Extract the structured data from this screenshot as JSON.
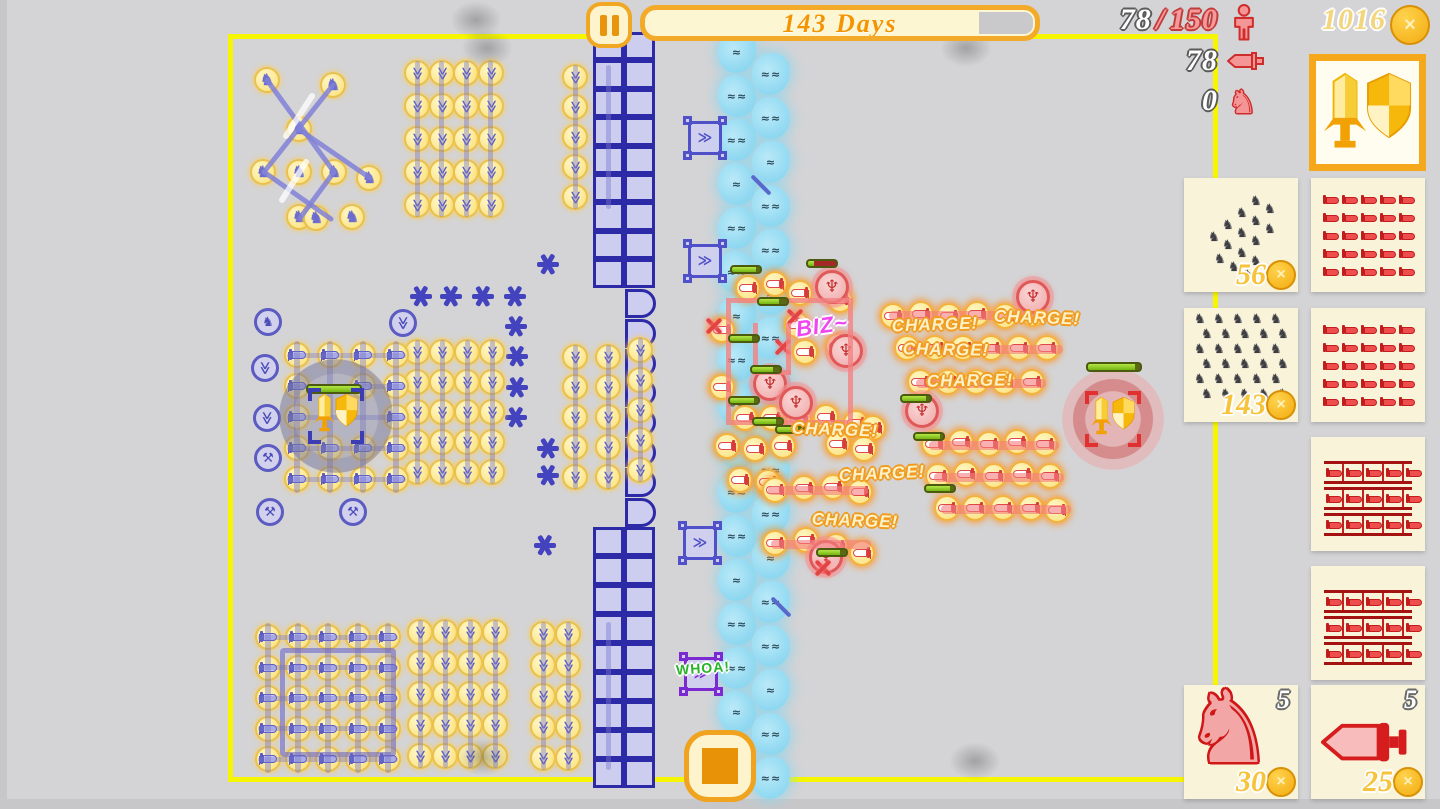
{
  "hud": {
    "days_banner": {
      "label": "143 Days",
      "progress_pct": 86
    },
    "population": {
      "current": "78",
      "sep": "/",
      "max": "150"
    },
    "melee_count": "78",
    "cavalry_count": "0",
    "gold": "1016",
    "icons": {
      "pause": "pause-icon",
      "population": "person-icon",
      "melee": "sword-icon",
      "cavalry": "horse-icon",
      "gold": "coin-icon",
      "stop": "stop-icon"
    },
    "colors": {
      "accent_orange": "#f3aa28",
      "field_border": "#f6f600",
      "banner_text": "#f49400",
      "coin_gold": "#f3ab10"
    }
  },
  "sidebar": {
    "selected_card": {
      "name": "commander-emblem"
    },
    "cards": [
      {
        "id": "cavalry-wedge",
        "glyph": "horse-wedge",
        "count": "56",
        "col": 0,
        "row": 0
      },
      {
        "id": "swords-grid-a",
        "glyph": "sword-grid",
        "col": 1,
        "row": 0
      },
      {
        "id": "cavalry-grid",
        "glyph": "horse-grid",
        "count": "143",
        "col": 0,
        "row": 1
      },
      {
        "id": "swords-grid-b",
        "glyph": "sword-grid",
        "col": 1,
        "row": 1
      },
      {
        "id": "pike-formation-a",
        "glyph": "pike-grid",
        "col": 1,
        "row": 2
      },
      {
        "id": "pike-formation-b",
        "glyph": "pike-grid",
        "col": 1,
        "row": 3
      },
      {
        "id": "cavalry-single",
        "glyph": "horse-big",
        "badge": "5",
        "count": "30",
        "col": 0,
        "row": 4
      },
      {
        "id": "sword-single",
        "glyph": "sword-big",
        "badge": "5",
        "count": "25",
        "col": 1,
        "row": 4
      }
    ]
  },
  "battle": {
    "labels": [
      {
        "text": "CHARGE!",
        "x": 935,
        "y": 325,
        "rot": -2
      },
      {
        "text": "CHARGE!",
        "x": 1037,
        "y": 318,
        "rot": 2
      },
      {
        "text": "CHARGE!",
        "x": 946,
        "y": 350,
        "rot": 1
      },
      {
        "text": "CHARGE!",
        "x": 970,
        "y": 381,
        "rot": -1
      },
      {
        "text": "CHARGE!",
        "x": 835,
        "y": 430,
        "rot": 2
      },
      {
        "text": "CHARGE!",
        "x": 882,
        "y": 474,
        "rot": -3
      },
      {
        "text": "CHARGE!",
        "x": 855,
        "y": 521,
        "rot": 2
      },
      {
        "text": "BIZ~",
        "x": 822,
        "y": 326,
        "rot": -8,
        "style": "biz"
      },
      {
        "text": "WHOA!",
        "x": 703,
        "y": 668,
        "rot": -4,
        "style": "whoa"
      }
    ],
    "blue_cavalry": [
      [
        267,
        80
      ],
      [
        333,
        85
      ],
      [
        299,
        129
      ],
      [
        263,
        172
      ],
      [
        299,
        172
      ],
      [
        334,
        172
      ],
      [
        369,
        178
      ],
      [
        299,
        217
      ],
      [
        352,
        217
      ],
      [
        316,
        218
      ]
    ],
    "cavalry_lines": [
      [
        267,
        80,
        334,
        172
      ],
      [
        333,
        85,
        264,
        172
      ],
      [
        300,
        130,
        370,
        178
      ],
      [
        264,
        172,
        331,
        219
      ],
      [
        334,
        172,
        300,
        218
      ]
    ],
    "white_streaks": [
      [
        312,
        96,
        286,
        136
      ],
      [
        306,
        162,
        282,
        200
      ]
    ],
    "blue_ghosts": [
      [
        268,
        322,
        "h"
      ],
      [
        265,
        368,
        "b"
      ],
      [
        267,
        418,
        "b"
      ],
      [
        268,
        458,
        "m"
      ],
      [
        270,
        512,
        "m"
      ],
      [
        353,
        512,
        "m"
      ],
      [
        403,
        323,
        "b"
      ]
    ],
    "caltrops": [
      [
        548,
        264
      ],
      [
        421,
        296
      ],
      [
        451,
        296
      ],
      [
        483,
        296
      ],
      [
        515,
        296
      ],
      [
        516,
        326
      ],
      [
        517,
        356
      ],
      [
        517,
        387
      ],
      [
        516,
        417
      ],
      [
        548,
        448
      ],
      [
        548,
        475
      ],
      [
        545,
        545
      ]
    ],
    "archer_grids": [
      {
        "x0": 417,
        "y0": 73,
        "dx": 24.5,
        "dy": 33,
        "cols": 4,
        "rows": 5
      },
      {
        "xs": [
          575,
          608
        ],
        "y0": 77,
        "dy": 30,
        "rows": 5
      },
      {
        "x0": 417,
        "y0": 352,
        "dx": 25,
        "dy": 30,
        "cols": 4,
        "rows": 5
      },
      {
        "xs": [
          575,
          608
        ],
        "y0": 357,
        "dy": 30,
        "rows": 5
      },
      {
        "xs": [
          640
        ],
        "y0": 350,
        "dy": 30,
        "rows": 5
      },
      {
        "x0": 420,
        "y0": 632,
        "dx": 25,
        "dy": 31,
        "cols": 4,
        "rows": 5
      },
      {
        "xs": [
          543,
          568
        ],
        "y0": 634,
        "dy": 31,
        "rows": 5
      },
      {
        "xs": [
          608
        ],
        "y0": 634,
        "dy": 31,
        "rows": 5
      }
    ],
    "sword_grids": [
      {
        "xs": [
          297,
          330,
          363,
          396
        ],
        "y0": 355,
        "dy": 31,
        "rows": 5,
        "skip": [
          [
            1,
            1
          ],
          [
            1,
            2
          ],
          [
            2,
            2
          ]
        ]
      },
      {
        "x0": 268,
        "y0": 637,
        "dx": 30,
        "dy": 30.6,
        "cols": 5,
        "rows": 5
      }
    ],
    "bottom_frame": {
      "x": 280,
      "y": 648,
      "w": 106,
      "h": 99
    },
    "wall": {
      "top": {
        "x": 593,
        "y": 32,
        "cols": 2,
        "rows": 9,
        "cw": 31,
        "ch": 28.4
      },
      "bottom": {
        "x": 593,
        "y": 527,
        "cols": 2,
        "rows": 9,
        "cw": 31,
        "ch": 29
      },
      "gates": {
        "x": 625,
        "y": 289,
        "count": 8,
        "dy": 29.8
      }
    },
    "ballistas": [
      {
        "x": 705,
        "y": 138
      },
      {
        "x": 705,
        "y": 261
      },
      {
        "x": 700,
        "y": 543
      },
      {
        "x": 701,
        "y": 674,
        "purple": true
      }
    ],
    "river": {
      "cols": [
        {
          "x": 737,
          "y0": 52
        },
        {
          "x": 771,
          "y0": 74
        }
      ],
      "dy": 44,
      "count": 17
    },
    "fort": {
      "x": 726,
      "y": 298,
      "w": 117,
      "h": 117
    },
    "fort_bars": [
      [
        753,
        323,
        5,
        52
      ],
      [
        786,
        323,
        5,
        52
      ],
      [
        753,
        370,
        38,
        5
      ]
    ],
    "red_units": [
      [
        722,
        330
      ],
      [
        748,
        288
      ],
      [
        775,
        284
      ],
      [
        800,
        293
      ],
      [
        840,
        300
      ],
      [
        797,
        325
      ],
      [
        805,
        352
      ],
      [
        838,
        346
      ],
      [
        722,
        387
      ],
      [
        745,
        418
      ],
      [
        772,
        418
      ],
      [
        799,
        419
      ],
      [
        826,
        417
      ],
      [
        856,
        423
      ],
      [
        873,
        428
      ],
      [
        727,
        446
      ],
      [
        755,
        449
      ],
      [
        783,
        446
      ],
      [
        838,
        444
      ],
      [
        864,
        449
      ],
      [
        740,
        480
      ],
      [
        768,
        482
      ],
      [
        775,
        490
      ],
      [
        804,
        488
      ],
      [
        833,
        487
      ],
      [
        860,
        492
      ],
      [
        775,
        543
      ],
      [
        806,
        540
      ],
      [
        836,
        546
      ],
      [
        862,
        553
      ],
      [
        893,
        316
      ],
      [
        921,
        314
      ],
      [
        949,
        316
      ],
      [
        977,
        314
      ],
      [
        1005,
        316
      ],
      [
        1033,
        314
      ],
      [
        907,
        348
      ],
      [
        935,
        348
      ],
      [
        963,
        348
      ],
      [
        991,
        348
      ],
      [
        1019,
        348
      ],
      [
        1047,
        348
      ],
      [
        920,
        382
      ],
      [
        948,
        382
      ],
      [
        976,
        382
      ],
      [
        1004,
        382
      ],
      [
        1032,
        382
      ],
      [
        934,
        444
      ],
      [
        961,
        442
      ],
      [
        989,
        444
      ],
      [
        1017,
        442
      ],
      [
        1045,
        444
      ],
      [
        938,
        476
      ],
      [
        966,
        474
      ],
      [
        994,
        476
      ],
      [
        1022,
        474
      ],
      [
        1050,
        476
      ],
      [
        947,
        508
      ],
      [
        975,
        508
      ],
      [
        1003,
        508
      ],
      [
        1031,
        508
      ],
      [
        1057,
        510
      ]
    ],
    "red_knights": [
      [
        832,
        287
      ],
      [
        846,
        351
      ],
      [
        770,
        384
      ],
      [
        796,
        403
      ],
      [
        922,
        411
      ],
      [
        1033,
        297
      ],
      [
        826,
        557
      ]
    ],
    "red_lines": [
      [
        889,
        311,
        160
      ],
      [
        903,
        345,
        160
      ],
      [
        916,
        379,
        130
      ],
      [
        929,
        441,
        130
      ],
      [
        934,
        473,
        130
      ],
      [
        941,
        505,
        130
      ],
      [
        768,
        486,
        100
      ],
      [
        771,
        540,
        100
      ]
    ],
    "red_stars": [
      [
        714,
        326
      ],
      [
        783,
        347
      ],
      [
        795,
        317
      ],
      [
        823,
        568
      ]
    ],
    "health_bars": [
      {
        "x": 730,
        "y": 265,
        "p": 85
      },
      {
        "x": 757,
        "y": 297,
        "p": 70
      },
      {
        "x": 728,
        "y": 334,
        "p": 80
      },
      {
        "x": 750,
        "y": 365,
        "p": 75
      },
      {
        "x": 728,
        "y": 396,
        "p": 85
      },
      {
        "x": 752,
        "y": 417,
        "p": 80
      },
      {
        "x": 775,
        "y": 425,
        "p": 75
      },
      {
        "x": 806,
        "y": 259,
        "p": 20,
        "dmg": true
      },
      {
        "x": 913,
        "y": 432,
        "p": 90
      },
      {
        "x": 924,
        "y": 484,
        "p": 85
      },
      {
        "x": 816,
        "y": 548,
        "p": 80
      },
      {
        "x": 900,
        "y": 394,
        "p": 85
      }
    ],
    "arrows": [
      [
        748,
        183
      ],
      [
        768,
        605
      ]
    ],
    "smoke": [
      [
        476,
        20
      ],
      [
        487,
        48
      ],
      [
        966,
        48
      ],
      [
        975,
        761
      ],
      [
        483,
        757
      ]
    ],
    "commanders": {
      "blue": {
        "x": 336,
        "y": 416,
        "halo": 114,
        "bar": {
          "x": 306,
          "y": 384,
          "p": 100
        }
      },
      "red": {
        "x": 1113,
        "y": 419,
        "halo": 102,
        "bar": {
          "x": 1086,
          "y": 362,
          "p": 90
        }
      }
    }
  }
}
